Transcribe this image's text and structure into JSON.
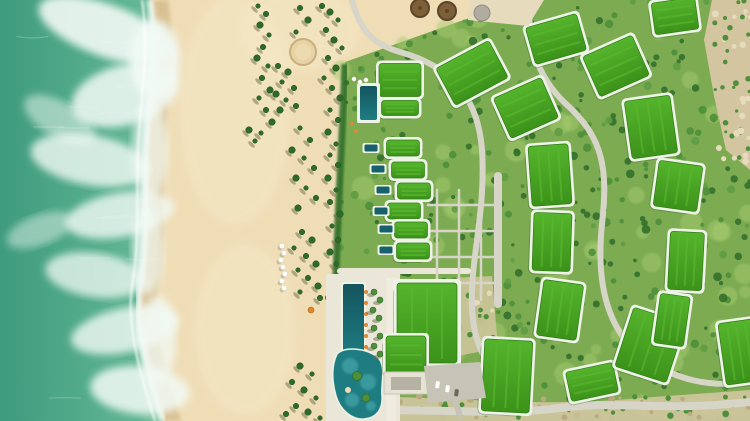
{
  "scene": {
    "description": "Aerial drone view of a beachfront resort: turquoise surf and foam on the left, a wide sandy beach with scattered palm trees and a row of white sun umbrellas in the middle, and on the right a landscaped resort with bright grass-covered green roofs arranged in two arcs, a column of villas with private plunge pools, a long dark lap pool with a lagoon pool, winding grey paths and tan scrubland at the edges."
  },
  "palette": {
    "ocean_deep": "#3f9b7e",
    "ocean_mid": "#5db395",
    "ocean_light": "#8cc7a8",
    "foam": "#f2faf5",
    "white": "#ffffff",
    "sand": "#efddb6",
    "sand_bright": "#f6e9c8",
    "sand_wet": "#d8c092",
    "resort_green": "#7cab52",
    "lawn_light": "#a8cc70",
    "tree_dark": "#33702b",
    "tree_mid": "#4f8f3a",
    "tree_light": "#5f9c44",
    "roof_green": "#46a31f",
    "roof_green_hi": "#55b42c",
    "roof_green_lo": "#3c921a",
    "roof_stripe": "#5cb930",
    "roof_edge": "#2e7d12",
    "roof_border": "#edf3e6",
    "pool_dark": "#16616b",
    "pool_mid": "#1f7d82",
    "pool_light": "#41a0a5",
    "path_grey": "#d7d5c8",
    "deck": "#eae6d8",
    "deck_bright": "#f0ece0",
    "road_grey": "#c6c4b6",
    "scrub": "#d2c5a0",
    "scrub_bright": "#e6dcbd",
    "scrub_dot": "#b9aa80",
    "orange": "#e0872f",
    "thatch": "#7d5f38",
    "thatch_edge": "#5c452a",
    "car_dark": "#6b685c",
    "palm_crown": "#2e6b28",
    "palm_edge": "#224f1e",
    "palm_shadow": "#6b6b4a",
    "building_shadow": "#1e4f16"
  },
  "ocean": {
    "shore_path": "M0,0 L150,0 C158,50 148,100 146,150 C144,200 148,240 140,285 C134,330 150,380 163,421 L0,421 Z",
    "wet_path": "M0,0 L168,0 C176,50 166,100 164,150 C162,200 166,240 158,285 C152,330 168,380 181,421 L0,421 Z",
    "waterline": "M150,0 C158,50 148,100 146,150 C144,200 148,240 140,285 C134,330 150,380 163,421",
    "foam_blobs": [
      [
        105,
        30,
        70,
        26,
        20,
        0.9
      ],
      [
        125,
        95,
        55,
        30,
        -15,
        0.85
      ],
      [
        90,
        160,
        60,
        25,
        10,
        0.8
      ],
      [
        120,
        215,
        55,
        22,
        -10,
        0.8
      ],
      [
        95,
        275,
        50,
        22,
        8,
        0.75
      ],
      [
        125,
        330,
        55,
        22,
        -12,
        0.8
      ],
      [
        140,
        390,
        50,
        24,
        5,
        0.85
      ],
      [
        60,
        120,
        40,
        18,
        30,
        0.5
      ],
      [
        40,
        230,
        35,
        15,
        -20,
        0.45
      ],
      [
        155,
        60,
        25,
        40,
        0,
        0.9
      ],
      [
        150,
        150,
        18,
        50,
        0,
        0.7
      ],
      [
        148,
        250,
        16,
        45,
        0,
        0.7
      ],
      [
        158,
        340,
        18,
        45,
        0,
        0.75
      ]
    ],
    "streak_count": 12
  },
  "beach": {
    "bright_spots": [
      [
        235,
        110,
        55,
        115
      ],
      [
        245,
        330,
        50,
        85
      ],
      [
        300,
        30,
        60,
        40
      ]
    ],
    "fire_circle": {
      "x": 303,
      "y": 52,
      "r": 13
    },
    "construction_poly": "M470,0 L544,0 L528,26 L468,20 Z",
    "thatch_huts": [
      [
        420,
        8
      ],
      [
        447,
        11
      ]
    ],
    "grey_disc": [
      482,
      13
    ],
    "palms": [
      [
        258,
        6
      ],
      [
        266,
        14
      ],
      [
        260,
        25
      ],
      [
        269,
        35
      ],
      [
        263,
        47
      ],
      [
        257,
        58
      ],
      [
        268,
        66
      ],
      [
        262,
        78
      ],
      [
        270,
        90
      ],
      [
        259,
        98
      ],
      [
        266,
        110
      ],
      [
        272,
        122
      ],
      [
        261,
        133
      ],
      [
        322,
        6
      ],
      [
        330,
        12
      ],
      [
        338,
        20
      ],
      [
        326,
        30
      ],
      [
        334,
        40
      ],
      [
        342,
        48
      ],
      [
        328,
        58
      ],
      [
        336,
        68
      ],
      [
        324,
        78
      ],
      [
        332,
        88
      ],
      [
        340,
        98
      ],
      [
        330,
        110
      ],
      [
        338,
        120
      ],
      [
        328,
        132
      ],
      [
        336,
        144
      ],
      [
        278,
        66
      ],
      [
        288,
        72
      ],
      [
        282,
        82
      ],
      [
        294,
        88
      ],
      [
        276,
        94
      ],
      [
        286,
        100
      ],
      [
        296,
        106
      ],
      [
        280,
        110
      ],
      [
        300,
        128
      ],
      [
        310,
        140
      ],
      [
        292,
        150
      ],
      [
        304,
        158
      ],
      [
        314,
        168
      ],
      [
        296,
        178
      ],
      [
        306,
        188
      ],
      [
        316,
        198
      ],
      [
        298,
        208
      ],
      [
        330,
        155
      ],
      [
        338,
        165
      ],
      [
        328,
        178
      ],
      [
        336,
        190
      ],
      [
        330,
        202
      ],
      [
        340,
        214
      ],
      [
        332,
        226
      ],
      [
        338,
        240
      ],
      [
        330,
        252
      ],
      [
        336,
        264
      ],
      [
        302,
        232
      ],
      [
        312,
        240
      ],
      [
        294,
        248
      ],
      [
        306,
        256
      ],
      [
        316,
        264
      ],
      [
        298,
        270
      ],
      [
        308,
        278
      ],
      [
        318,
        286
      ],
      [
        300,
        292
      ],
      [
        320,
        298
      ],
      [
        300,
        366
      ],
      [
        312,
        374
      ],
      [
        292,
        382
      ],
      [
        304,
        390
      ],
      [
        316,
        398
      ],
      [
        296,
        406
      ],
      [
        308,
        412
      ],
      [
        320,
        418
      ],
      [
        286,
        414
      ],
      [
        249,
        130
      ],
      [
        255,
        141
      ],
      [
        300,
        8
      ],
      [
        308,
        20
      ],
      [
        296,
        32
      ]
    ],
    "umbrellas_white": [
      [
        282,
        246
      ],
      [
        284,
        253
      ],
      [
        281,
        260
      ],
      [
        283,
        267
      ],
      [
        285,
        274
      ],
      [
        282,
        281
      ],
      [
        284,
        288
      ]
    ],
    "umbrella_orange": [
      311,
      310
    ],
    "beach_club_dots": [
      [
        354,
        79
      ],
      [
        360,
        82
      ],
      [
        366,
        80
      ]
    ]
  },
  "resort": {
    "base_poly": "M326,421 L330,400 L334,300 L338,200 L344,100 L345,62 L520,0 L750,0 L750,421 Z",
    "hedge_path": "M345,64 C342,140 338,210 336,275 C334,330 332,380 328,418",
    "scrub_top_right": "M712,0 L750,0 L750,170 L726,150 L714,96 L704,40 Z",
    "scrub_bottom": "M326,421 L330,398 C420,392 520,410 640,398 L750,390 L750,421 Z",
    "scrub_east_patch": "M452,278 L492,276 L498,348 L458,356 Z",
    "texture": {
      "seed": 7,
      "tree_count": 430,
      "lawn_count": 90
    }
  },
  "paths": {
    "arc_road": "M352,0 C360,30 372,44 400,52 C450,66 478,96 482,150 C486,214 470,258 472,308 C474,352 492,378 528,392",
    "outer_road": "M532,0 C524,36 536,76 566,104 C604,138 608,170 602,224 C596,282 606,330 644,358 C676,380 710,388 750,382",
    "bottom_road": "M332,414 C420,404 480,418 560,408 C620,400 660,412 750,402",
    "mid_road": "M498,176 L498,304",
    "promenade": "M340,271 L468,271",
    "parking_stub": "M455,400 L460,416",
    "grid_vx": [
      437,
      459,
      481
    ],
    "grid_vy": [
      190,
      300
    ],
    "grid_hy": [
      205,
      231,
      257,
      283
    ],
    "grid_hx": [
      428,
      497
    ]
  },
  "buildings": [
    {
      "x": 472,
      "y": 73,
      "w": 60,
      "h": 42,
      "r": -28
    },
    {
      "x": 526,
      "y": 108,
      "w": 52,
      "h": 44,
      "r": -24
    },
    {
      "x": 550,
      "y": 175,
      "w": 40,
      "h": 60,
      "r": -4
    },
    {
      "x": 552,
      "y": 242,
      "w": 38,
      "h": 58,
      "r": 2
    },
    {
      "x": 560,
      "y": 310,
      "w": 40,
      "h": 56,
      "r": 8
    },
    {
      "x": 592,
      "y": 382,
      "w": 48,
      "h": 30,
      "r": -12
    },
    {
      "x": 650,
      "y": 345,
      "w": 54,
      "h": 62,
      "r": 18
    },
    {
      "x": 556,
      "y": 39,
      "w": 53,
      "h": 38,
      "r": -16
    },
    {
      "x": 616,
      "y": 66,
      "w": 54,
      "h": 44,
      "r": -24
    },
    {
      "x": 651,
      "y": 127,
      "w": 46,
      "h": 58,
      "r": -8
    },
    {
      "x": 678,
      "y": 186,
      "w": 44,
      "h": 46,
      "r": 8
    },
    {
      "x": 686,
      "y": 261,
      "w": 34,
      "h": 58,
      "r": 3
    },
    {
      "x": 672,
      "y": 320,
      "w": 30,
      "h": 50,
      "r": 8
    },
    {
      "x": 675,
      "y": 16,
      "w": 44,
      "h": 32,
      "r": -8
    },
    {
      "x": 507,
      "y": 376,
      "w": 48,
      "h": 72,
      "r": 3
    },
    {
      "x": 740,
      "y": 352,
      "w": 36,
      "h": 62,
      "r": -8
    },
    {
      "x": 400,
      "y": 80,
      "w": 42,
      "h": 33,
      "r": 0
    },
    {
      "x": 400,
      "y": 108,
      "w": 37,
      "h": 15,
      "r": 0
    }
  ],
  "villas": {
    "roofs": [
      [
        403,
        148
      ],
      [
        408,
        170
      ],
      [
        414,
        191
      ],
      [
        404,
        211
      ],
      [
        411,
        230
      ],
      [
        413,
        251
      ]
    ],
    "pools": [
      [
        371,
        148
      ],
      [
        378,
        169
      ],
      [
        383,
        190
      ],
      [
        381,
        211
      ],
      [
        386,
        229
      ],
      [
        386,
        250
      ]
    ],
    "upper_pool": {
      "x": 360,
      "y": 86,
      "w": 17,
      "h": 34
    },
    "orange_dots": [
      [
        352,
        124
      ],
      [
        356,
        131
      ]
    ]
  },
  "pool_area": {
    "deck": {
      "x": 326,
      "y": 274,
      "w": 74,
      "h": 147
    },
    "deck_path": {
      "x": 386,
      "y": 278,
      "w": 10,
      "h": 143
    },
    "lap_pool": {
      "x": 343,
      "y": 284,
      "w": 21,
      "h": 76
    },
    "lagoon_path": "M337,354 C331,366 332,382 336,396 C340,410 352,420 364,419 C376,418 383,410 382,396 C381,384 385,372 381,362 C376,350 346,344 337,354 Z",
    "lagoon_lights": [
      [
        350,
        366,
        8
      ],
      [
        368,
        382,
        8
      ],
      [
        352,
        400,
        7
      ],
      [
        371,
        406,
        5
      ]
    ],
    "islands_green": [
      [
        357,
        376,
        4.5
      ],
      [
        366,
        398,
        4
      ]
    ],
    "islet_sand": [
      348,
      390,
      3
    ],
    "deck_palms": [
      [
        374,
        292
      ],
      [
        380,
        300
      ],
      [
        373,
        310
      ],
      [
        379,
        318
      ],
      [
        374,
        328
      ],
      [
        380,
        336
      ],
      [
        374,
        346
      ],
      [
        380,
        354
      ]
    ],
    "loungers": [
      [
        366,
        292
      ],
      [
        366,
        303
      ],
      [
        366,
        314
      ],
      [
        366,
        325
      ],
      [
        366,
        336
      ],
      [
        366,
        347
      ]
    ]
  },
  "main_building": {
    "roof1_border": {
      "x": 393,
      "y": 279,
      "w": 68,
      "h": 88
    },
    "roof1": {
      "x": 397,
      "y": 283,
      "w": 60,
      "h": 80
    },
    "roof2_border": {
      "x": 383,
      "y": 333,
      "w": 46,
      "h": 44
    },
    "roof2": {
      "x": 386,
      "y": 336,
      "w": 40,
      "h": 38
    },
    "canopy": {
      "x": 384,
      "y": 372,
      "w": 44,
      "h": 22
    },
    "canopy_inner": {
      "x": 391,
      "y": 377,
      "w": 30,
      "h": 13
    },
    "parking_poly": "M424,366 L480,362 L486,398 L428,403 Z",
    "cars_white": [
      [
        436,
        381
      ],
      [
        446,
        385
      ]
    ],
    "car_dark": [
      455,
      389
    ]
  }
}
